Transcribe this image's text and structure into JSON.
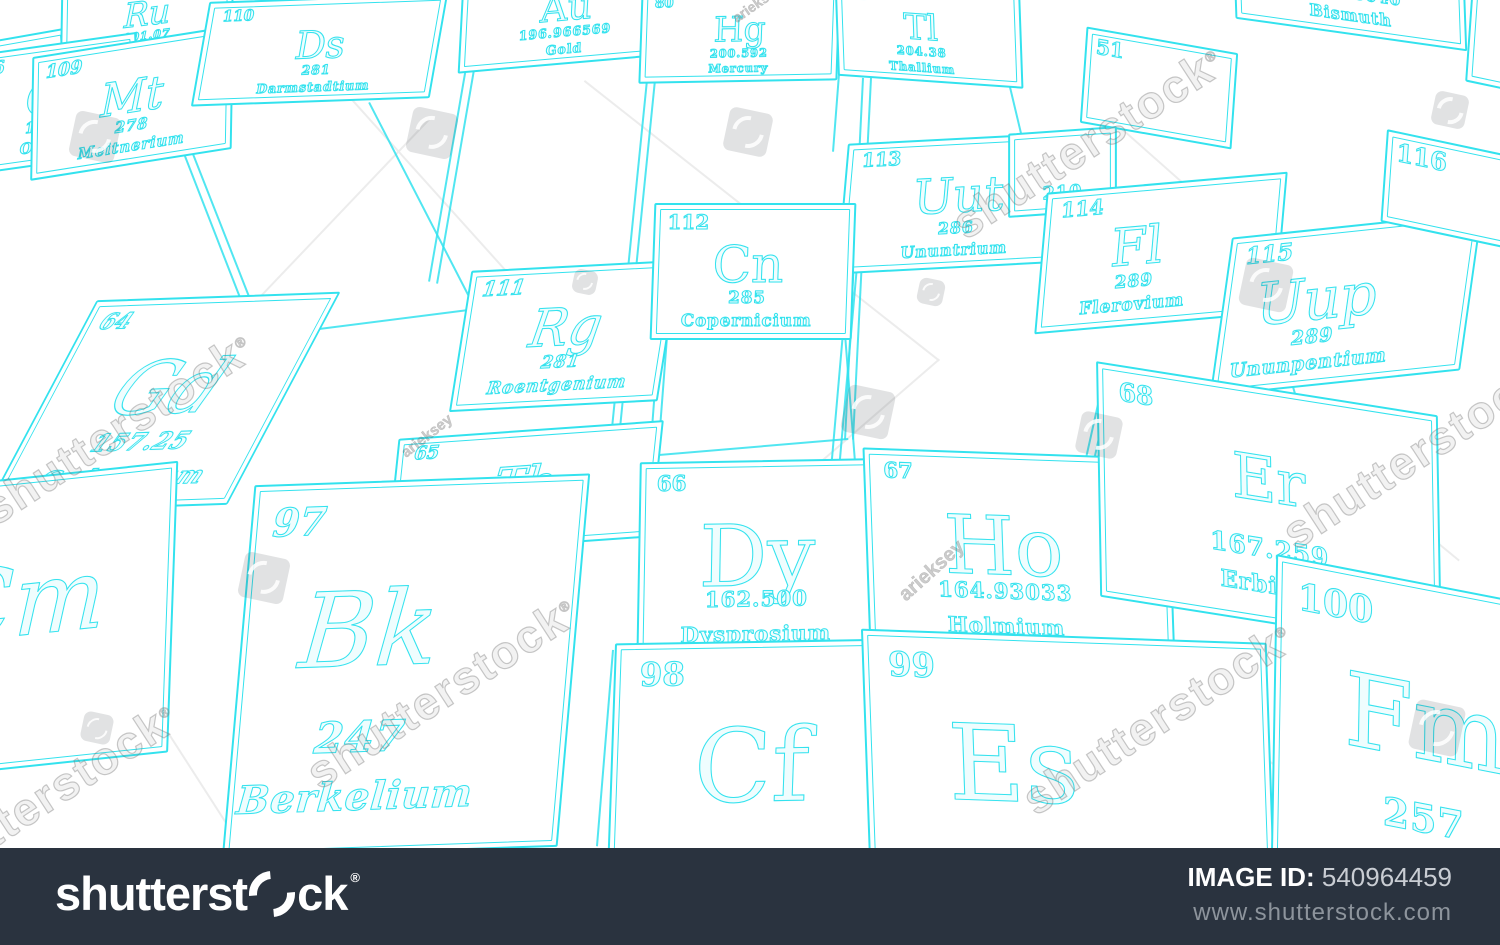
{
  "colors": {
    "tile_stroke": "#33e2ee",
    "background": "#ffffff",
    "bar_background": "#2a333f",
    "bar_text": "#ffffff",
    "bar_subtext": "#8d949c",
    "watermark_gray": "#7d7d7d"
  },
  "watermark": {
    "brand": "shutterstock",
    "registered_mark": "®",
    "artist": "arieksey"
  },
  "bottom_bar": {
    "logo_text_before_mark": "shutterst",
    "logo_text_after_mark": "ck",
    "registered_mark": "®",
    "image_id_label": "IMAGE ID:",
    "image_id": "540964459",
    "url": "www.shutterstock.com"
  },
  "tiles": [
    {
      "id": "tc",
      "number": "",
      "symbol": "Tc",
      "mass": "",
      "name": ""
    },
    {
      "id": "ru",
      "number": "",
      "symbol": "Ru",
      "mass": "101.07",
      "name": "Ruthenium"
    },
    {
      "id": "os",
      "number": "76",
      "symbol": "Os",
      "mass": "190.23",
      "name": "Osmium"
    },
    {
      "id": "mt",
      "number": "109",
      "symbol": "Mt",
      "mass": "278",
      "name": "Meitnerium"
    },
    {
      "id": "ds",
      "number": "110",
      "symbol": "Ds",
      "mass": "281",
      "name": "Darmstadtium"
    },
    {
      "id": "au",
      "number": "",
      "symbol": "Au",
      "mass": "196.966569",
      "name": "Gold"
    },
    {
      "id": "hg",
      "number": "80",
      "symbol": "Hg",
      "mass": "200.592",
      "name": "Mercury"
    },
    {
      "id": "tl",
      "number": "81",
      "symbol": "Tl",
      "mass": "204.38",
      "name": "Thallium"
    },
    {
      "id": "bi",
      "number": "",
      "symbol": "",
      "mass": "208.98040",
      "name": "Bismuth"
    },
    {
      "id": "pofrag",
      "number": "",
      "symbol": "",
      "mass": "",
      "name": ""
    },
    {
      "id": "sb51",
      "number": "51",
      "symbol": "",
      "mass": "",
      "name": ""
    },
    {
      "id": "uut",
      "number": "113",
      "symbol": "Uut",
      "mass": "286",
      "name": "Ununtrium"
    },
    {
      "id": "atfrag",
      "number": "",
      "symbol": "",
      "mass": "210",
      "name": ""
    },
    {
      "id": "fl",
      "number": "114",
      "symbol": "Fl",
      "mass": "289",
      "name": "Flerovium"
    },
    {
      "id": "uup",
      "number": "115",
      "symbol": "Uup",
      "mass": "289",
      "name": "Ununpentium"
    },
    {
      "id": "lv",
      "number": "116",
      "symbol": "",
      "mass": "",
      "name": ""
    },
    {
      "id": "rg",
      "number": "111",
      "symbol": "Rg",
      "mass": "281",
      "name": "Roentgenium"
    },
    {
      "id": "cn",
      "number": "112",
      "symbol": "Cn",
      "mass": "285",
      "name": "Copernicium"
    },
    {
      "id": "gd",
      "number": "64",
      "symbol": "Gd",
      "mass": "157.25",
      "name": "Gadolinium"
    },
    {
      "id": "tb",
      "number": "65",
      "symbol": "Tb",
      "mass": "",
      "name": ""
    },
    {
      "id": "dy",
      "number": "66",
      "symbol": "Dy",
      "mass": "162.500",
      "name": "Dysprosium"
    },
    {
      "id": "ho",
      "number": "67",
      "symbol": "Ho",
      "mass": "164.93033",
      "name": "Holmium"
    },
    {
      "id": "er",
      "number": "68",
      "symbol": "Er",
      "mass": "167.259",
      "name": "Erbium"
    },
    {
      "id": "cm",
      "number": "",
      "symbol": "Cm",
      "mass": "",
      "name": ""
    },
    {
      "id": "bk",
      "number": "97",
      "symbol": "Bk",
      "mass": "247",
      "name": "Berkelium"
    },
    {
      "id": "cf",
      "number": "98",
      "symbol": "Cf",
      "mass": "",
      "name": ""
    },
    {
      "id": "es",
      "number": "99",
      "symbol": "Es",
      "mass": "",
      "name": ""
    },
    {
      "id": "fm",
      "number": "100",
      "symbol": "Fm",
      "mass": "257",
      "name": ""
    }
  ]
}
